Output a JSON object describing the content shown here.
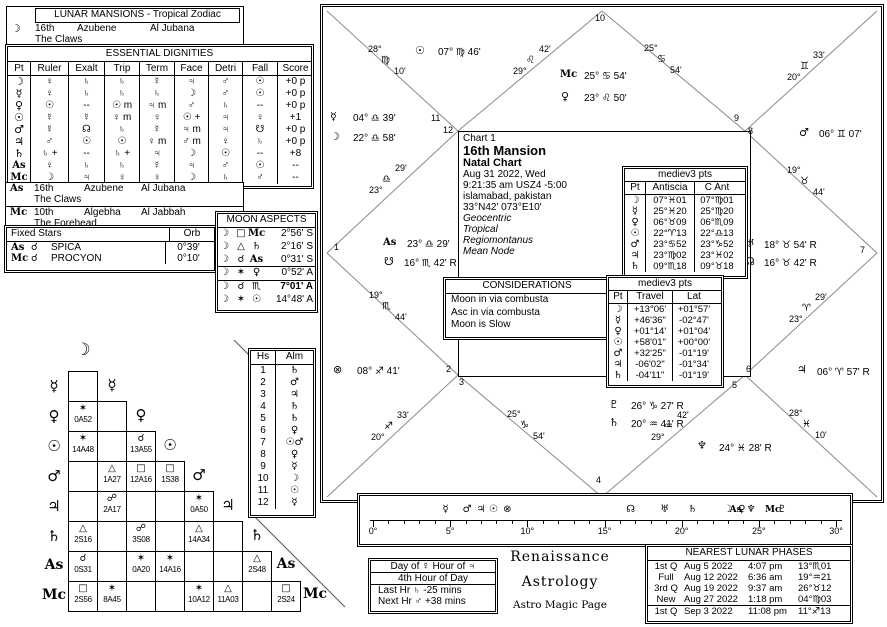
{
  "icons": {
    "moon": "☽",
    "mercury": "☿",
    "venus": "♀",
    "sun": "☉",
    "mars": "♂",
    "jupiter": "♃",
    "saturn": "♄",
    "uranus": "♅",
    "neptune": "♆",
    "pluto": "♇",
    "north-node": "☊",
    "south-node": "☋",
    "part-of-fortune": "⊗",
    "ascendant": "As",
    "midheaven": "Mc",
    "conjunction": "☌",
    "opposition": "☍",
    "trine": "△",
    "square": "□",
    "sextile": "✶"
  },
  "lunar_mansions": {
    "title": "LUNAR MANSIONS - Tropical Zodiac",
    "moon": {
      "pt": "☽",
      "mansion": "16th",
      "name": "Azubene",
      "alt_name": "Al Jubana",
      "meaning": "The Claws"
    },
    "asc": {
      "pt": "As",
      "mansion": "16th",
      "name": "Azubene",
      "alt_name": "Al Jubana",
      "meaning": "The Claws"
    },
    "mc": {
      "pt": "Mc",
      "mansion": "10th",
      "name": "Algebha",
      "alt_name": "Al Jabbah",
      "meaning": "The Forehead"
    }
  },
  "dignities": {
    "title": "ESSENTIAL DIGNITIES",
    "headers": [
      "Pt",
      "Ruler",
      "Exalt",
      "Trip",
      "Term",
      "Face",
      "Detri",
      "Fall",
      "Score"
    ],
    "rows": [
      [
        "☽",
        "♀",
        "♄",
        "♄",
        "☿",
        "♃",
        "♂",
        "☉",
        "+0 p"
      ],
      [
        "☿",
        "♀",
        "♄",
        "♄",
        "♄",
        "☽",
        "♂",
        "☉",
        "+0 p"
      ],
      [
        "♀",
        "☉",
        "--",
        "☉ m",
        "♃ m",
        "♂",
        "♄",
        "--",
        "+0 p"
      ],
      [
        "☉",
        "☿",
        "☿",
        "♀ m",
        "♀",
        "☉ +",
        "♃",
        "♀",
        "+1"
      ],
      [
        "♂",
        "☿",
        "☊",
        "♄",
        "☿",
        "♃ m",
        "♃",
        "☋",
        "+0 p"
      ],
      [
        "♃",
        "♂",
        "☉",
        "☉",
        "♀ m",
        "♂ m",
        "♀",
        "♄",
        "+0 p"
      ],
      [
        "♄",
        "♄ +",
        "--",
        "♄ +",
        "♃",
        "☽",
        "☉",
        "--",
        "+8"
      ],
      [
        "As",
        "♀",
        "♄",
        "♄",
        "☿",
        "♃",
        "♂",
        "☉",
        "--"
      ],
      [
        "Mc",
        "☽",
        "♃",
        "♀",
        "♀",
        "☽",
        "♄",
        "♂",
        "--"
      ]
    ]
  },
  "fixed_stars": {
    "title": "Fixed Stars",
    "orb_header": "Orb",
    "rows": [
      [
        "As",
        "☌",
        "SPICA",
        "0°39'"
      ],
      [
        "Mc",
        "☌",
        "PROCYON",
        "0°10'"
      ]
    ]
  },
  "moon_aspects": {
    "title": "MOON ASPECTS",
    "moon": "☽",
    "rows": [
      {
        "a": "□",
        "t": "Mc",
        "v": "2°56' S",
        "bold": false
      },
      {
        "a": "△",
        "t": "♄",
        "v": "2°16' S",
        "bold": false
      },
      {
        "a": "☌",
        "t": "As",
        "v": "0°31' S",
        "bold": false
      },
      {
        "a": "✶",
        "t": "♀",
        "v": "0°52' A",
        "bold": false
      },
      {
        "a": "☌",
        "t": "♏",
        "v": "7°01' A",
        "bold": true
      },
      {
        "a": "✶",
        "t": "☉",
        "v": "14°48' A",
        "bold": false
      }
    ]
  },
  "aspect_grid": {
    "planets": [
      "☽",
      "☿",
      "♀",
      "☉",
      "♂",
      "♃",
      "♄",
      "As",
      "Mc"
    ],
    "rows": [
      [
        null
      ],
      [
        {
          "a": "✶",
          "v": "0A52"
        },
        null
      ],
      [
        {
          "a": "✶",
          "v": "14A48"
        },
        null,
        {
          "a": "☌",
          "v": "13A55"
        }
      ],
      [
        null,
        {
          "a": "△",
          "v": "1A27"
        },
        {
          "a": "□",
          "v": "12A16"
        },
        {
          "a": "□",
          "v": "1S38"
        }
      ],
      [
        null,
        {
          "a": "☍",
          "v": "2A17"
        },
        null,
        null,
        {
          "a": "✶",
          "v": "0A50"
        }
      ],
      [
        {
          "a": "△",
          "v": "2S16"
        },
        null,
        {
          "a": "☍",
          "v": "3S08"
        },
        null,
        {
          "a": "△",
          "v": "14A34"
        },
        null
      ],
      [
        {
          "a": "☌",
          "v": "0S31"
        },
        null,
        {
          "a": "✶",
          "v": "0A20"
        },
        {
          "a": "✶",
          "v": "14A16"
        },
        null,
        null,
        {
          "a": "△",
          "v": "2S48"
        }
      ],
      [
        {
          "a": "□",
          "v": "2S56"
        },
        {
          "a": "✶",
          "v": "8A45"
        },
        null,
        null,
        {
          "a": "✶",
          "v": "10A12"
        },
        {
          "a": "△",
          "v": "11A03"
        },
        null,
        {
          "a": "□",
          "v": "2S24"
        }
      ]
    ]
  },
  "houses_almuten": {
    "headers": [
      "Hs",
      "Alm"
    ],
    "rows": [
      [
        "1",
        "♄"
      ],
      [
        "2",
        "♂"
      ],
      [
        "3",
        "♃"
      ],
      [
        "4",
        "♄"
      ],
      [
        "5",
        "♄"
      ],
      [
        "6",
        "♀"
      ],
      [
        "7",
        "☉♂"
      ],
      [
        "8",
        "♀"
      ],
      [
        "9",
        "☿"
      ],
      [
        "10",
        "☽"
      ],
      [
        "11",
        "☉"
      ],
      [
        "12",
        "☿"
      ]
    ]
  },
  "chart": {
    "id": "Chart 1",
    "title": "16th Mansion",
    "subtitle": "Natal Chart",
    "date": "Aug 31 2022, Wed",
    "time": "9:21:35 am  USZ4 -5:00",
    "location": "islamabad, pakistan",
    "coordinates": "33°N42' 073°E10'",
    "settings": [
      "Geocentric",
      "Tropical",
      "Regiomontanus",
      "Mean Node"
    ],
    "house_numbers": [
      "1",
      "2",
      "3",
      "4",
      "5",
      "6",
      "7",
      "8",
      "9",
      "10",
      "11",
      "12"
    ],
    "cusps": [
      {
        "deg": "23°",
        "sign": "♎",
        "min": "29'"
      },
      {
        "deg": "19°",
        "sign": "♏",
        "min": "44'"
      },
      {
        "deg": "20°",
        "sign": "♐",
        "min": "33'"
      },
      {
        "deg": "25°",
        "sign": "♑",
        "min": "54'"
      },
      {
        "deg": "29°",
        "sign": "♒",
        "min": "42'"
      },
      {
        "deg": "28°",
        "sign": "♓",
        "min": "10'"
      },
      {
        "deg": "23°",
        "sign": "♈",
        "min": "29'"
      },
      {
        "deg": "19°",
        "sign": "♉",
        "min": "44'"
      },
      {
        "deg": "20°",
        "sign": "♊",
        "min": "33'"
      },
      {
        "deg": "25°",
        "sign": "♋",
        "min": "54'"
      },
      {
        "deg": "29°",
        "sign": "♌",
        "min": "42'"
      },
      {
        "deg": "28°",
        "sign": "♍",
        "min": "10'"
      }
    ],
    "planets": [
      {
        "name": "sun",
        "glyph": "☉",
        "text": "07° ♍ 46'"
      },
      {
        "name": "midheaven",
        "glyph": "Mc",
        "text": "25° ♋ 54'"
      },
      {
        "name": "venus",
        "glyph": "♀",
        "text": "23° ♌ 50'"
      },
      {
        "name": "mercury",
        "glyph": "☿",
        "text": "04° ♎ 39'"
      },
      {
        "name": "moon",
        "glyph": "☽",
        "text": "22° ♎ 58'"
      },
      {
        "name": "ascendant",
        "glyph": "As",
        "text": "23° ♎ 29'"
      },
      {
        "name": "south-node",
        "glyph": "☋",
        "text": "16° ♏ 42' R"
      },
      {
        "name": "part-of-fortune",
        "glyph": "⊗",
        "text": "08° ♐ 41'"
      },
      {
        "name": "mars",
        "glyph": "♂",
        "text": "06° ♊ 07'"
      },
      {
        "name": "uranus",
        "glyph": "♅",
        "text": "18° ♉ 54' R"
      },
      {
        "name": "north-node",
        "glyph": "☊",
        "text": "16° ♉ 42' R"
      },
      {
        "name": "jupiter",
        "glyph": "♃",
        "text": "06° ♈ 57' R"
      },
      {
        "name": "neptune",
        "glyph": "♆",
        "text": "24° ♓ 28' R"
      },
      {
        "name": "pluto",
        "glyph": "♇",
        "text": "26° ♑ 27' R"
      },
      {
        "name": "saturn",
        "glyph": "♄",
        "text": "20° ♒ 41' R"
      }
    ]
  },
  "antiscia": {
    "title": "mediev3 pts",
    "headers": [
      "Pt",
      "Antiscia",
      "C Ant"
    ],
    "rows": [
      [
        "☽",
        "07°♓01",
        "07°♍01"
      ],
      [
        "☿",
        "25°♓20",
        "25°♍20"
      ],
      [
        "♀",
        "06°♉09",
        "06°♏09"
      ],
      [
        "☉",
        "22°♈13",
        "22°♎13"
      ],
      [
        "♂",
        "23°♋52",
        "23°♑52"
      ],
      [
        "♃",
        "23°♍02",
        "23°♓02"
      ],
      [
        "♄",
        "09°♏18",
        "09°♉18"
      ]
    ]
  },
  "travel": {
    "title": "mediev3 pts",
    "headers": [
      "Pt",
      "Travel",
      "Lat"
    ],
    "rows": [
      [
        "☽",
        "+13°06'",
        "+01°57'"
      ],
      [
        "☿",
        "+46'36\"",
        "-02°47'"
      ],
      [
        "♀",
        "+01°14'",
        "+01°04'"
      ],
      [
        "☉",
        "+58'01\"",
        "+00°00'"
      ],
      [
        "♂",
        "+32'25\"",
        "-01°19'"
      ],
      [
        "♃",
        "-06'02\"",
        "-01°34'"
      ],
      [
        "♄",
        "-04'11\"",
        "-01°19'"
      ]
    ]
  },
  "considerations": {
    "title": "CONSIDERATIONS",
    "lines": [
      "Moon in via combusta",
      "Asc in via combusta",
      "Moon is Slow"
    ]
  },
  "ruler": {
    "tick_labels": [
      "0°",
      "5°",
      "10°",
      "15°",
      "20°",
      "25°",
      "30°"
    ],
    "max_deg": 30,
    "planets": [
      {
        "glyph": "☿",
        "deg": 4.7
      },
      {
        "glyph": "♂",
        "deg": 6.1
      },
      {
        "glyph": "♃",
        "deg": 7.0
      },
      {
        "glyph": "☉",
        "deg": 7.8
      },
      {
        "glyph": "⊗",
        "deg": 8.7
      },
      {
        "glyph": "☊",
        "deg": 16.7
      },
      {
        "glyph": "♅",
        "deg": 18.9
      },
      {
        "glyph": "♄",
        "deg": 20.7
      },
      {
        "glyph": "☽",
        "deg": 23.0
      },
      {
        "glyph": "As",
        "deg": 23.5
      },
      {
        "glyph": "♀",
        "deg": 23.9
      },
      {
        "glyph": "♆",
        "deg": 24.5
      },
      {
        "glyph": "Mc",
        "deg": 25.9
      },
      {
        "glyph": "♇",
        "deg": 26.5
      }
    ]
  },
  "hours": {
    "header": "Day of ☿    Hour of ♃",
    "subheader": "4th Hour of Day",
    "last_hour": "Last Hr ♄  -25 mins",
    "next_hour": "Next Hr ♂  +38 mins"
  },
  "branding": {
    "line1": "Renaissance",
    "line2": "Astrology",
    "line3": "Astro Magic Page"
  },
  "phases": {
    "title": "NEAREST LUNAR PHASES",
    "rows": [
      [
        "1st Q",
        "Aug 5 2022",
        "4:07 pm",
        "13°♏01"
      ],
      [
        "Full",
        "Aug 12 2022",
        "6:36 am",
        "19°♒21"
      ],
      [
        "3rd Q",
        "Aug 19 2022",
        "9:37 am",
        "26°♉12"
      ],
      [
        "New",
        "Aug 27 2022",
        "1:18 pm",
        "04°♍03"
      ],
      [
        "1st Q",
        "Sep 3 2022",
        "11:08 pm",
        "11°♐13"
      ]
    ]
  }
}
